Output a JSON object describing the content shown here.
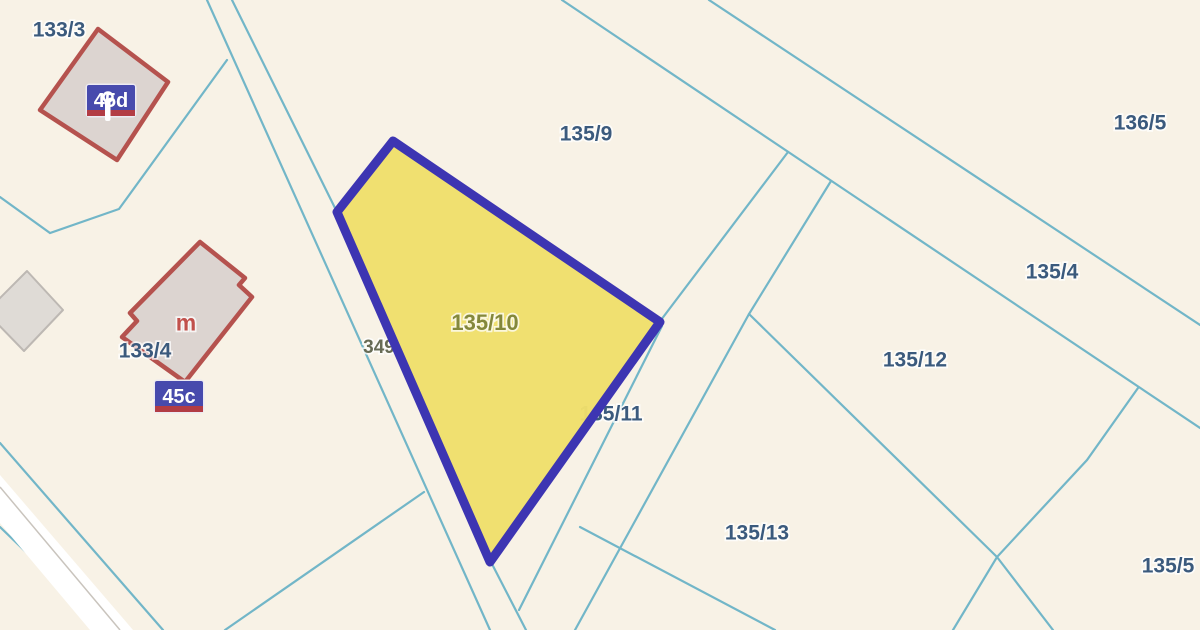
{
  "map": {
    "width": 1200,
    "height": 630,
    "colors": {
      "background": "#f8f2e6",
      "boundary_line": "#72b6c8",
      "highlight_fill": "#efdf6b",
      "highlight_border": "#3d35b2",
      "building_stroke": "#b5524e",
      "building_fill": "#dcd4d0",
      "gray_building_fill": "#dfdbd6",
      "gray_building_stroke": "#bdb8b3",
      "label_navy": "#3b5a7d",
      "label_olive": "#84883b",
      "label_gray_olive": "#686c55",
      "label_red": "#c1504b",
      "badge_blue": "#474aad",
      "badge_red_strip": "#b23c44",
      "badge_text": "#ffffff",
      "road_band": "#ffffff",
      "road_centerline": "#c9c4bd"
    },
    "boundaries": [
      {
        "name": "road-edge-west",
        "points": "207,0 490,630"
      },
      {
        "name": "road-edge-east",
        "points": "232,0 337,212"
      },
      {
        "name": "road-edge-east-lower",
        "points": "492,564 526,630"
      },
      {
        "name": "boundary-133-3-south",
        "points": "0,197 50,233 119,209 227,60"
      },
      {
        "name": "boundary-branch-sw",
        "points": "424,492 225,630"
      },
      {
        "name": "boundary-main-ne-1",
        "points": "562,0 845,190 1200,428"
      },
      {
        "name": "boundary-main-ne-2",
        "points": "709,0 1200,325"
      },
      {
        "name": "boundary-strip-west",
        "points": "788,152 661,320"
      },
      {
        "name": "boundary-strip-east",
        "points": "831,181 749,314 575,630"
      },
      {
        "name": "boundary-135-11-east",
        "points": "662,326 519,610"
      },
      {
        "name": "boundary-135-13-west",
        "points": "580,527 775,630"
      },
      {
        "name": "boundary-135-12-south",
        "points": "749,314 997,557"
      },
      {
        "name": "boundary-135-12-south-ext",
        "points": "997,557 1053,630"
      },
      {
        "name": "boundary-135-5-west",
        "points": "1138,388 1087,460 997,557 953,630"
      },
      {
        "name": "road-sw-edge-north",
        "points": "0,443 163,630"
      },
      {
        "name": "road-sw-edge-south",
        "points": "0,527 107,630"
      }
    ],
    "road_band": {
      "name": "road-sw-band",
      "polygon": "0,475 133,630 90,630 0,523",
      "centerline": "0,487 120,630"
    },
    "buildings": [
      {
        "name": "building-45d",
        "points": "98,29 168,82 117,160 40,110",
        "type": "outlined"
      },
      {
        "name": "building-45c",
        "points": "200,242 245,278 239,285 252,297 185,382 122,337 137,321 130,313",
        "type": "outlined"
      },
      {
        "name": "building-gray",
        "points": "27,271 63,310 24,351 -14,312",
        "type": "plain"
      }
    ],
    "highlight_parcel": {
      "name": "parcel-135-10",
      "number": "135/10",
      "points": "393,141 337,212 490,562 660,322"
    },
    "labels_under": [
      {
        "text": "349",
        "x": 379,
        "y": 346,
        "size": 19,
        "color": "#686c55"
      },
      {
        "text": "135/11",
        "x": 611,
        "y": 413,
        "size": 21,
        "color": "#3b5a7d"
      }
    ],
    "labels_over": [
      {
        "text": "133/3",
        "x": 59,
        "y": 29,
        "size": 21,
        "color": "#3b5a7d"
      },
      {
        "text": "133/4",
        "x": 145,
        "y": 350,
        "size": 21,
        "color": "#3b5a7d"
      },
      {
        "text": "135/9",
        "x": 586,
        "y": 133,
        "size": 21,
        "color": "#3b5a7d"
      },
      {
        "text": "136/5",
        "x": 1140,
        "y": 122,
        "size": 21,
        "color": "#3b5a7d"
      },
      {
        "text": "135/4",
        "x": 1052,
        "y": 271,
        "size": 21,
        "color": "#3b5a7d"
      },
      {
        "text": "135/12",
        "x": 915,
        "y": 359,
        "size": 21,
        "color": "#3b5a7d"
      },
      {
        "text": "135/13",
        "x": 757,
        "y": 532,
        "size": 21,
        "color": "#3b5a7d"
      },
      {
        "text": "135/5",
        "x": 1168,
        "y": 565,
        "size": 21,
        "color": "#3b5a7d"
      },
      {
        "text": "135/10",
        "x": 485,
        "y": 322,
        "size": 22,
        "color": "#84883b"
      }
    ],
    "house_letter": {
      "text": "m",
      "x": 186,
      "y": 322,
      "size": 23,
      "color": "#c1504b"
    },
    "address_badges": [
      {
        "name": "address-badge-45d",
        "text": "45d",
        "x": 87,
        "y": 85,
        "w": 48,
        "h": 31,
        "pole_symbol": true
      },
      {
        "name": "address-badge-45c",
        "text": "45c",
        "x": 155,
        "y": 381,
        "w": 48,
        "h": 31,
        "pole_symbol": false
      }
    ]
  }
}
